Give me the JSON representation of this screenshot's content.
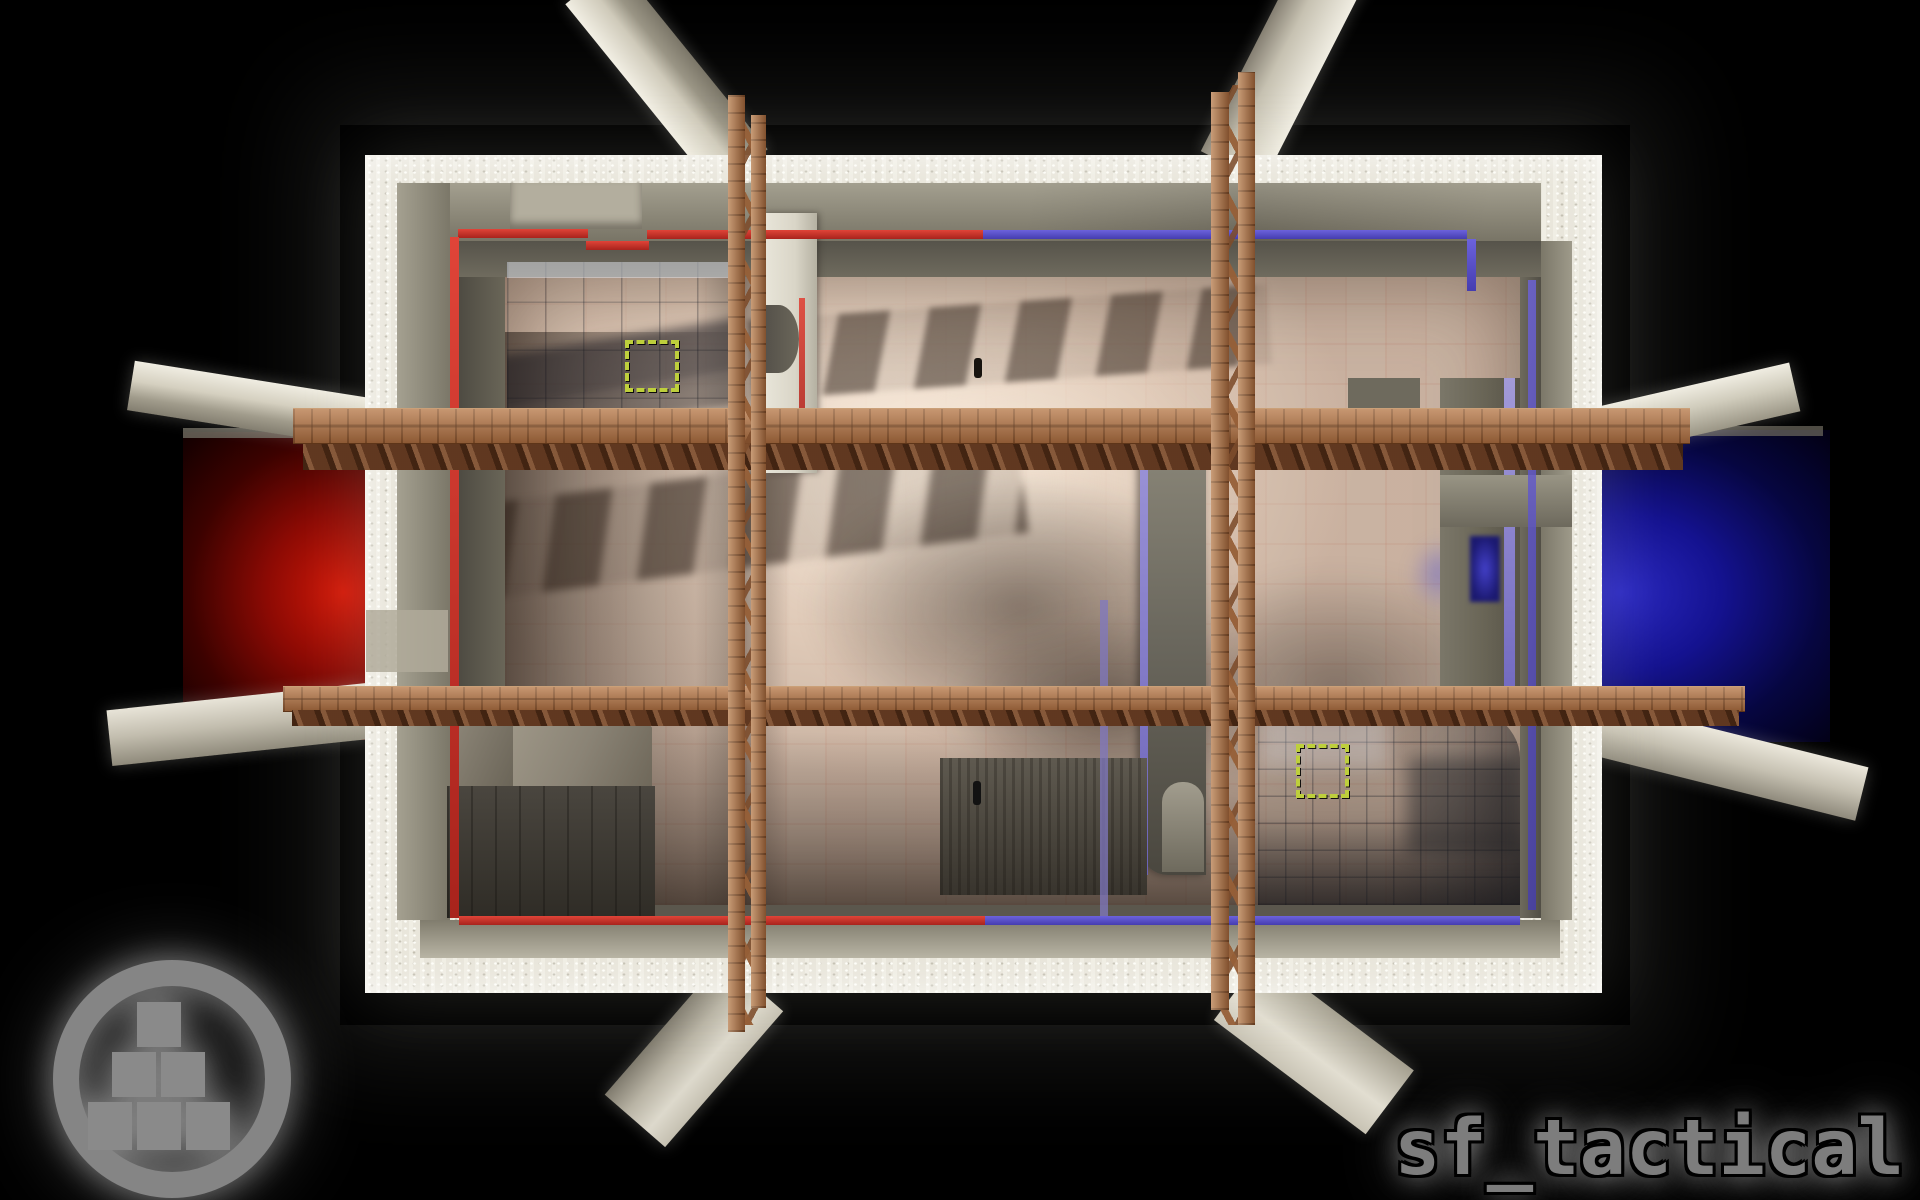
{
  "map": {
    "title": "sf_tactical",
    "view": "top-down overhead render of a rectangular arena",
    "areas": {
      "red_spawn": "red-lit side room on the west exterior",
      "blue_spawn": "blue-lit side room on the east exterior",
      "buyzone_northwest": "hazard-striped square marker on northwest stone floor",
      "buyzone_southeast": "hazard-striped square marker on southeast tiled floor"
    },
    "colors": {
      "background": "#000000",
      "outer_rim_stone": "#e9e6db",
      "wall_concrete": "#8d8979",
      "wall_shadow": "#56534a",
      "floor_beige": "#e3cfc0",
      "floor_stone_blue": "#7d8596",
      "team_red_stripe": "#c5312a",
      "team_blue_stripe": "#5a50c8",
      "red_room_glow": "#c01008",
      "blue_room_glow": "#1c1aa8",
      "hazard_marker": "#becf3c",
      "wood_beam": "#a96f45",
      "logo_gray": "#8a8a8a",
      "title_text": "#7d7d7d"
    }
  },
  "watermark": {
    "icon": "stacked-blocks-in-ring"
  }
}
